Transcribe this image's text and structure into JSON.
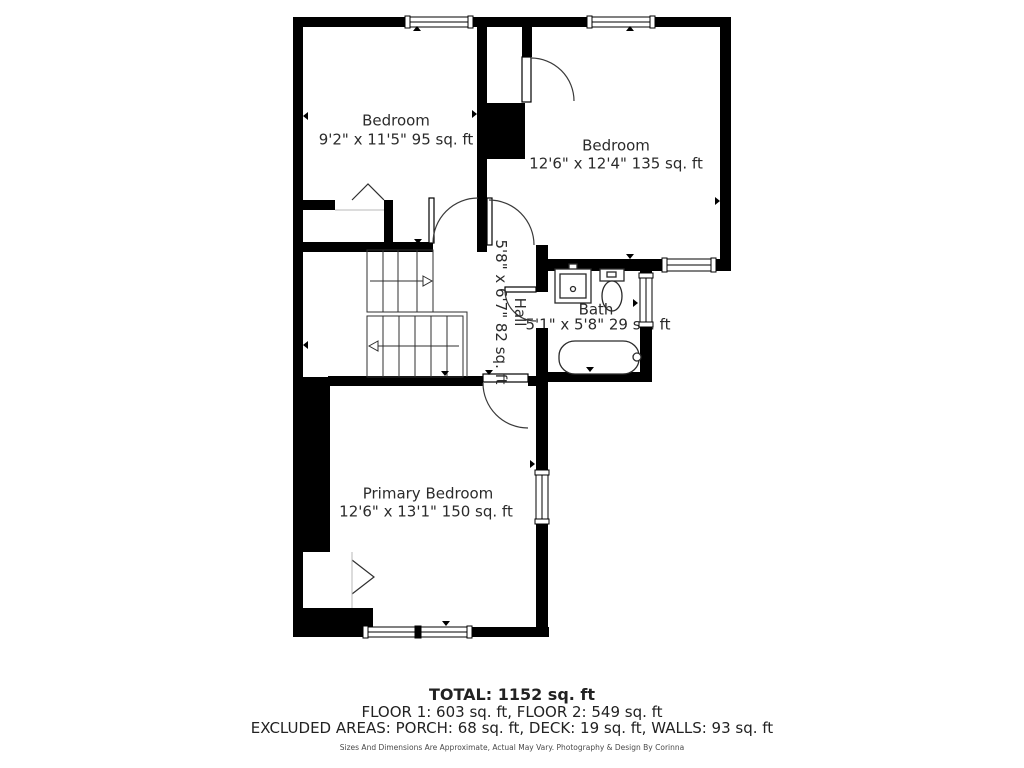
{
  "rooms": {
    "bedroom1": {
      "name": "Bedroom",
      "dims": "9'2\" x 11'5\" 95 sq. ft"
    },
    "bedroom2": {
      "name": "Bedroom",
      "dims": "12'6\" x 12'4\" 135 sq. ft"
    },
    "hall": {
      "name": "Hall",
      "dims": "5'8\" x 6'7\" 82 sq. ft"
    },
    "bath": {
      "name": "Bath",
      "dims": "5'1\" x 5'8\" 29 sq. ft"
    },
    "primary": {
      "name": "Primary Bedroom",
      "dims": "12'6\" x 13'1\" 150 sq. ft"
    }
  },
  "summary": {
    "total": "TOTAL: 1152 sq. ft",
    "floors": "FLOOR 1: 603 sq. ft, FLOOR 2: 549 sq. ft",
    "excluded": "EXCLUDED AREAS: PORCH: 68 sq. ft, DECK: 19 sq. ft, WALLS: 93 sq. ft",
    "disclaimer": "Sizes And Dimensions Are Approximate, Actual May Vary. Photography & Design By Corinna"
  },
  "colors": {
    "wall": "#000000",
    "text": "#2b2b2b",
    "disclaimer_text": "#4a4a4a",
    "background": "#ffffff"
  }
}
